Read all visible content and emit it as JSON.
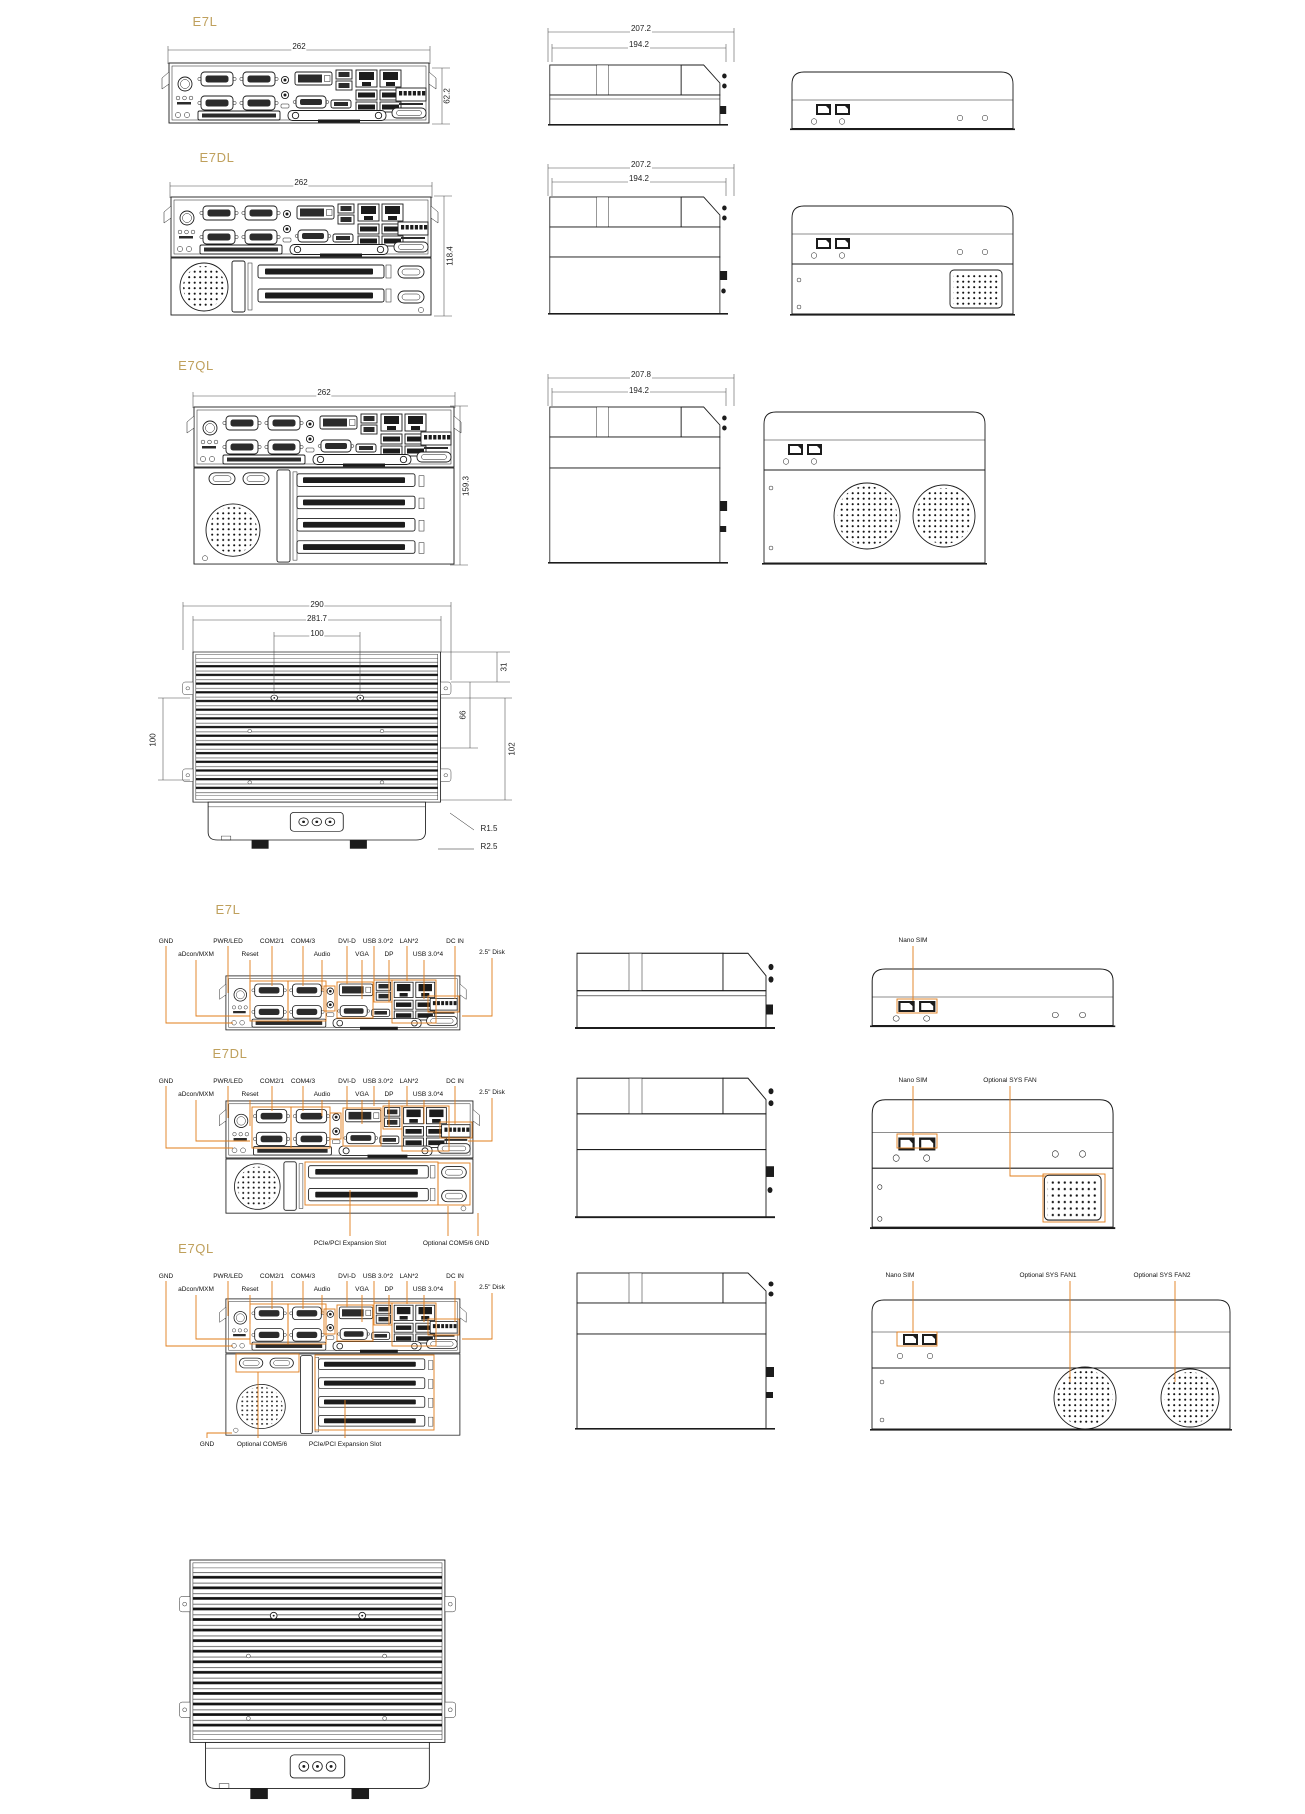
{
  "colors": {
    "line": "#1c1c1c",
    "accent": "#E07C1A",
    "title": "#BFA05C"
  },
  "models": {
    "e7l": {
      "title": "E7L",
      "front_width": "262",
      "front_height": "62.2",
      "side_depth": "207.2",
      "side_depth_inner": "194.2"
    },
    "e7dl": {
      "title": "E7DL",
      "front_width": "262",
      "front_height": "118.4",
      "side_depth": "207.2",
      "side_depth_inner": "194.2"
    },
    "e7ql": {
      "title": "E7QL",
      "front_width": "262",
      "front_height": "159.3",
      "side_depth": "207.8",
      "side_depth_inner": "194.2"
    }
  },
  "top_view": {
    "overall_width": "290",
    "inner_width": "281.7",
    "hole_spacing_x": "100",
    "hole_spacing_y": "100",
    "edge_offset": "31",
    "mid_offset": "66",
    "lower_offset": "102",
    "fillet_1": "R1.5",
    "fillet_2": "R2.5"
  },
  "io_labels": {
    "gnd": "GND",
    "pwr_led": "PWR/LED",
    "com21": "COM2/1",
    "com43": "COM4/3",
    "dvi": "DVI-D",
    "usb2": "USB 3.0*2",
    "lan": "LAN*2",
    "dcin": "DC IN",
    "adcon": "aDcon/MXM",
    "reset": "Reset",
    "audio": "Audio",
    "vga": "VGA",
    "dp": "DP",
    "usb4": "USB 3.0*4",
    "disk": "2.5\" Disk",
    "expansion": "PCIe/PCI Expansion Slot",
    "com56": "Optional COM5/6",
    "nano_sim": "Nano SIM",
    "sys_fan": "Optional SYS FAN",
    "sys_fan1": "Optional SYS FAN1",
    "sys_fan2": "Optional SYS FAN2"
  }
}
